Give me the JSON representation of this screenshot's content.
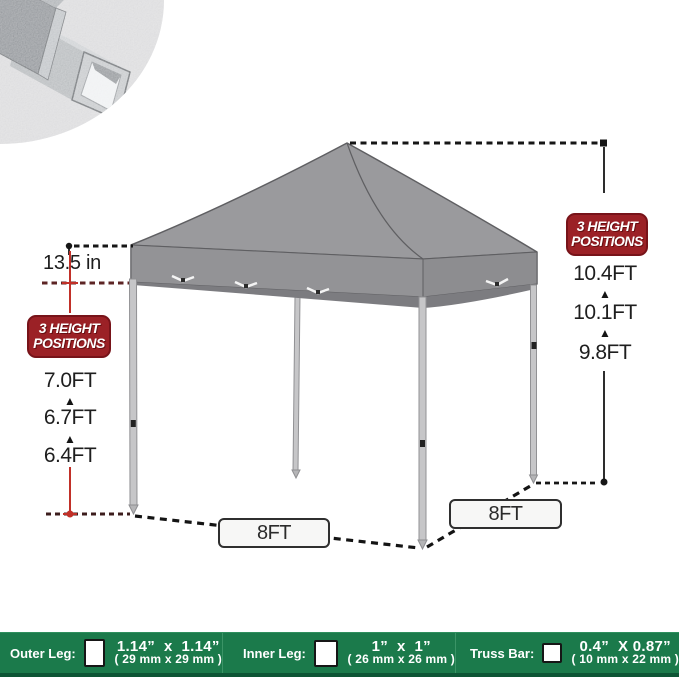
{
  "title": "pop-up canopy tent size diagram with 3 height positions",
  "inset": {
    "name": "metal square tube close-up photo"
  },
  "annotations": {
    "canopy_valance_height": "13.5 in",
    "arrow_glyph": "▲",
    "badge_left": {
      "line1": "3 HEIGHT",
      "line2": "POSITIONS"
    },
    "badge_right": {
      "line1": "3 HEIGHT",
      "line2": "POSITIONS"
    },
    "left_heights": [
      "7.0FT",
      "6.7FT",
      "6.4FT"
    ],
    "right_heights": [
      "10.4FT",
      "10.1FT",
      "9.8FT"
    ],
    "base_left": "8FT",
    "base_right": "8FT"
  },
  "spec_bar": {
    "sections": [
      {
        "label": "Outer Leg:",
        "inches": "1.14”  x  1.14”",
        "mm": "( 29 mm x 29 mm )"
      },
      {
        "label": "Inner Leg:",
        "inches": "1”  x  1”",
        "mm": "( 26 mm x 26 mm )"
      },
      {
        "label": "Truss Bar:",
        "inches": "0.4”  X 0.87”",
        "mm": "( 10 mm x 22 mm )"
      }
    ]
  },
  "colors": {
    "bar_green": "#1b7a4b",
    "bar_green_dark": "#0d5535",
    "badge_red": "#9b2126",
    "canopy_gray": "#9a9a9d",
    "canopy_underside_gray": "#7c7c80",
    "measure_red": "#c13028"
  }
}
